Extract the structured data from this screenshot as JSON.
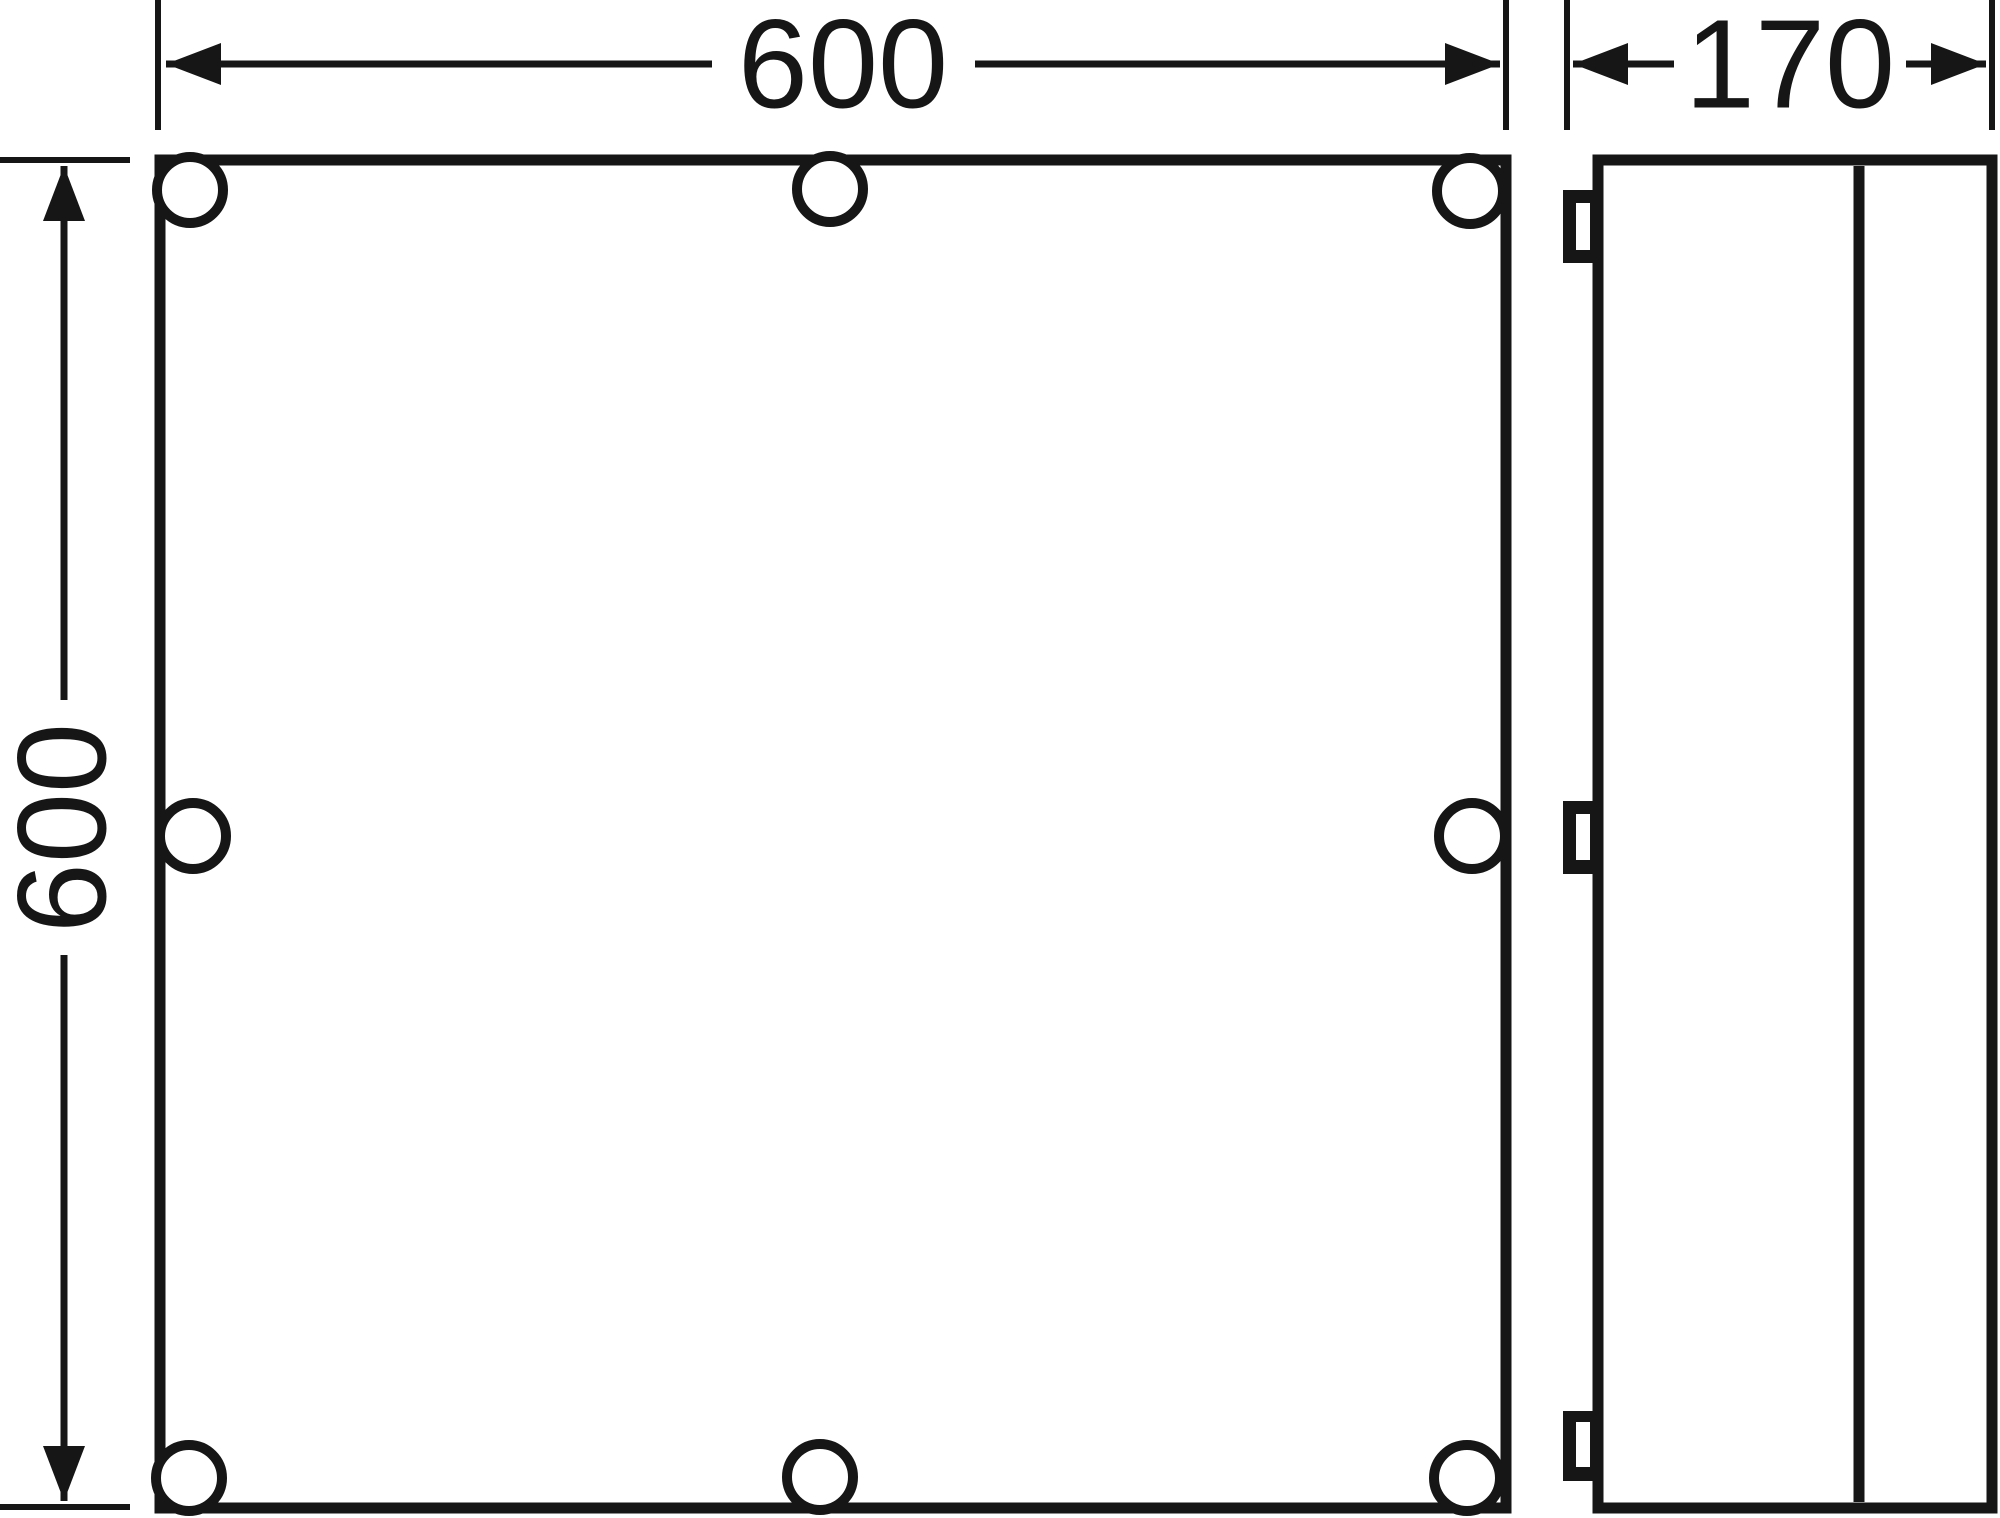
{
  "theme": {
    "ink": "#161616",
    "paper": "#ffffff"
  },
  "drawing": {
    "front_view": {
      "width_label": "600",
      "height_label": "600"
    },
    "side_view": {
      "depth_label": "170"
    }
  }
}
